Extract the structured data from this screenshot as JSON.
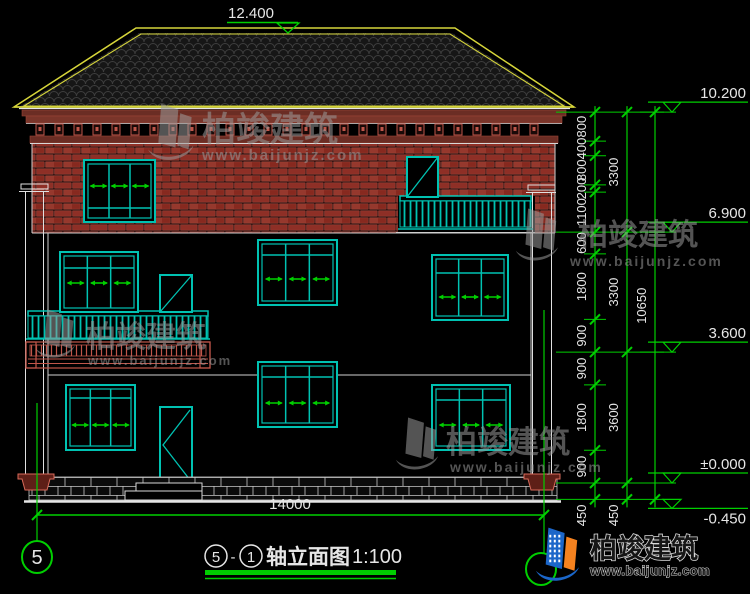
{
  "colors": {
    "background": "#000000",
    "cad_green": "#00cf00",
    "cad_teal": "#00c2b2",
    "cad_white": "#e6e6e6",
    "roof_yellow": "#d6d53a",
    "brick_red": "#8e2f26",
    "trim_salmon": "#c0564a",
    "watermark_gray": "#9a9a9a",
    "logo_blue": "#1b66c9",
    "logo_orange": "#f5821f"
  },
  "title_block": {
    "axis_from": "5",
    "separator": "-",
    "axis_to": "1",
    "name": "轴立面图",
    "scale": "1:100"
  },
  "axes": {
    "left_bubble": "5"
  },
  "dimensions": {
    "overall_width": "14000",
    "ridge_elevation": "12.400",
    "right_chain_inner": [
      "800",
      "400",
      "800",
      "200",
      "1100",
      "600",
      "1800",
      "900",
      "900",
      "1800",
      "900",
      "450"
    ],
    "right_chain_middle": [
      "3300",
      "3300",
      "3600",
      "450"
    ],
    "right_chain_outer": [
      "10650"
    ],
    "elevation_markers": [
      {
        "label": "10.200",
        "level_mm": 10200
      },
      {
        "label": "6.900",
        "level_mm": 6900
      },
      {
        "label": "3.600",
        "level_mm": 3600
      },
      {
        "label": "±0.000",
        "level_mm": 0
      },
      {
        "label": "-0.450",
        "level_mm": -450
      }
    ]
  },
  "watermark": {
    "brand": "柏竣建筑",
    "website": "www.baijunjz.com"
  },
  "logo": {
    "brand": "柏竣建筑",
    "website": "www.baijunjz.com"
  }
}
